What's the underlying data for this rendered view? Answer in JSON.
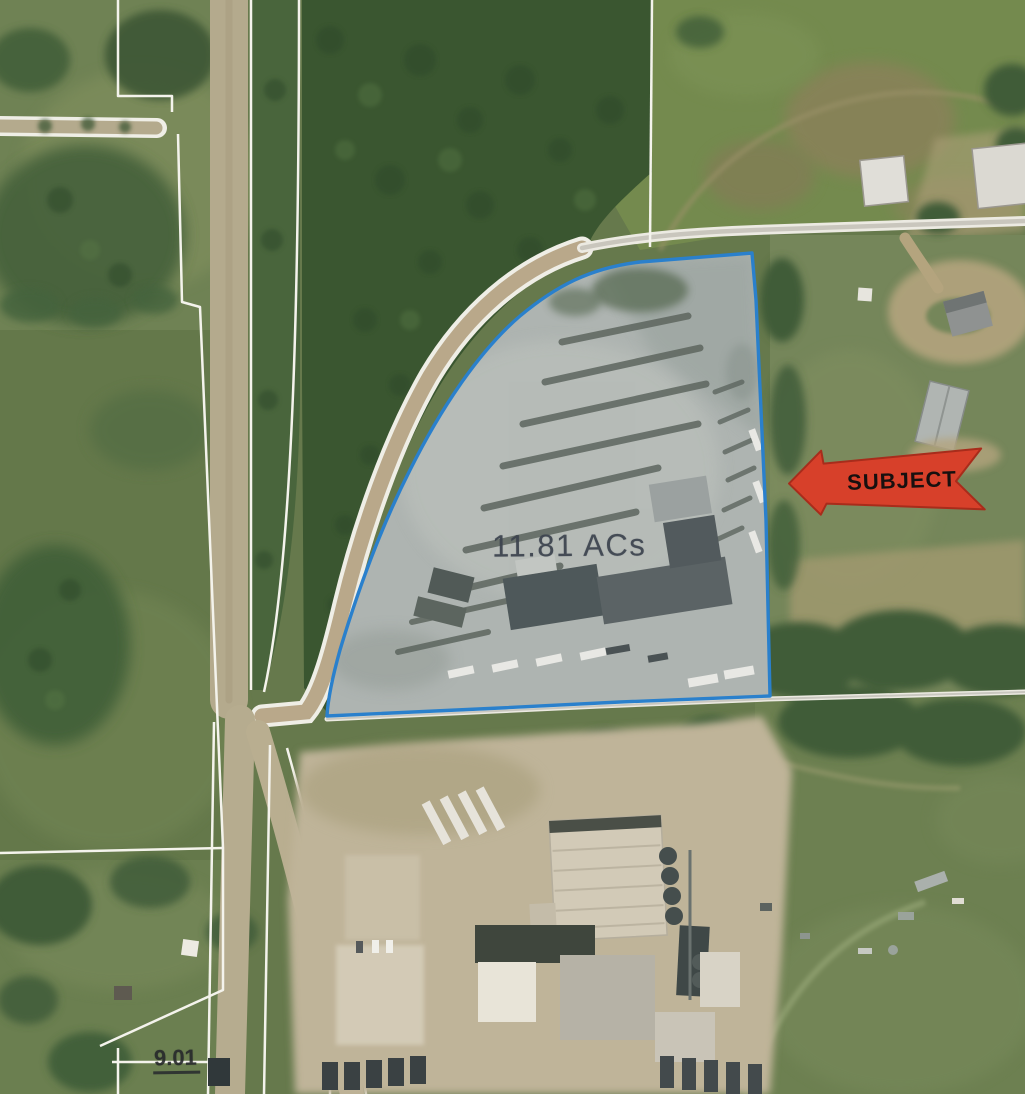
{
  "map": {
    "labels": {
      "subject_area": "11.81 ACs",
      "parcel_number": "9.01",
      "subject_callout": "SUBJECT"
    },
    "colors": {
      "subject_boundary": "#2a80cc",
      "callout_arrow_fill": "#d7402a",
      "callout_arrow_border": "#a82c1b",
      "callout_text": "#17100f",
      "subject_area_text": "#3c434e",
      "parcel_number_text": "#26292b",
      "parcel_lines": "#f4f3ec",
      "road_dirt": "#b6ab8e",
      "subject_gravel": "#aeb4b1"
    }
  }
}
